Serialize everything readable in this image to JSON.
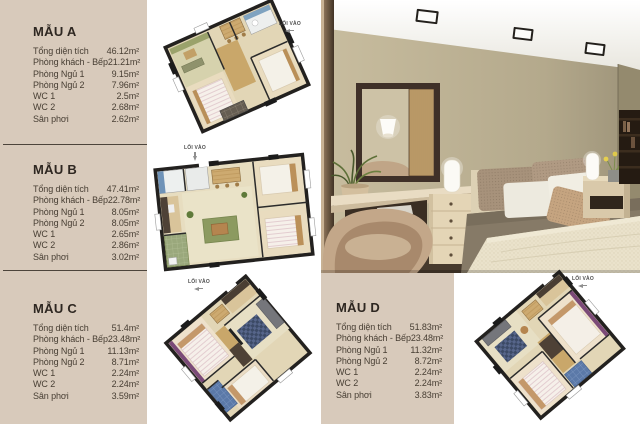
{
  "page": {
    "background": "#d8cabb",
    "panel_white": "#ffffff",
    "divider_color": "#4c443b",
    "title_color": "#2e2721",
    "body_color": "#473e33"
  },
  "panels": [
    {
      "id": "mau-a",
      "title": "MẪU A",
      "rows": [
        {
          "label": "Tổng diện tích",
          "value": "46.12m²"
        },
        {
          "label": "Phòng khách - Bếp",
          "value": "21.21m²"
        },
        {
          "label": "Phòng Ngủ 1",
          "value": "9.15m²"
        },
        {
          "label": "Phòng Ngủ 2",
          "value": "7.96m²"
        },
        {
          "label": "WC 1",
          "value": "2.5m²"
        },
        {
          "label": "WC 2",
          "value": "2.68m²"
        },
        {
          "label": "Sân phơi",
          "value": "2.62m²"
        }
      ]
    },
    {
      "id": "mau-b",
      "title": "MẪU B",
      "rows": [
        {
          "label": "Tổng diện tích",
          "value": "47.41m²"
        },
        {
          "label": "Phòng khách - Bếp",
          "value": "22.78m²"
        },
        {
          "label": "Phòng Ngủ 1",
          "value": "8.05m²"
        },
        {
          "label": "Phòng Ngủ 2",
          "value": "8.05m²"
        },
        {
          "label": "WC 1",
          "value": "2.65m²"
        },
        {
          "label": "WC 2",
          "value": "2.86m²"
        },
        {
          "label": "Sân phơi",
          "value": "3.02m²"
        }
      ]
    },
    {
      "id": "mau-c",
      "title": "MẪU C",
      "rows": [
        {
          "label": "Tổng diện tích",
          "value": "51.4m²"
        },
        {
          "label": "Phòng khách - Bếp",
          "value": "23.48m²"
        },
        {
          "label": "Phòng Ngủ 1",
          "value": "11.13m²"
        },
        {
          "label": "Phòng Ngủ 2",
          "value": "8.71m²"
        },
        {
          "label": "WC 1",
          "value": "2.24m²"
        },
        {
          "label": "WC 2",
          "value": "2.24m²"
        },
        {
          "label": "Sân phơi",
          "value": "3.59m²"
        }
      ]
    },
    {
      "id": "mau-d",
      "title": "MẪU D",
      "rows": [
        {
          "label": "Tổng diện tích",
          "value": "51.83m²"
        },
        {
          "label": "Phòng khách - Bếp",
          "value": "23.48m²"
        },
        {
          "label": "Phòng Ngủ 1",
          "value": "11.32m²"
        },
        {
          "label": "Phòng Ngủ 2",
          "value": "8.72m²"
        },
        {
          "label": "WC 1",
          "value": "2.24m²"
        },
        {
          "label": "WC 2",
          "value": "2.24m²"
        },
        {
          "label": "Sân phơi",
          "value": "3.83m²"
        }
      ]
    }
  ],
  "floor_plans": [
    {
      "id": "plan-a",
      "entrance_label": "LỐI VÀO"
    },
    {
      "id": "plan-b",
      "entrance_label": "LỐI VÀO"
    },
    {
      "id": "plan-c",
      "entrance_label": "LỐI VÀO"
    },
    {
      "id": "plan-d",
      "entrance_label": "LỐI VÀO"
    }
  ],
  "photo": {
    "alt": "bedroom interior 3D render"
  }
}
